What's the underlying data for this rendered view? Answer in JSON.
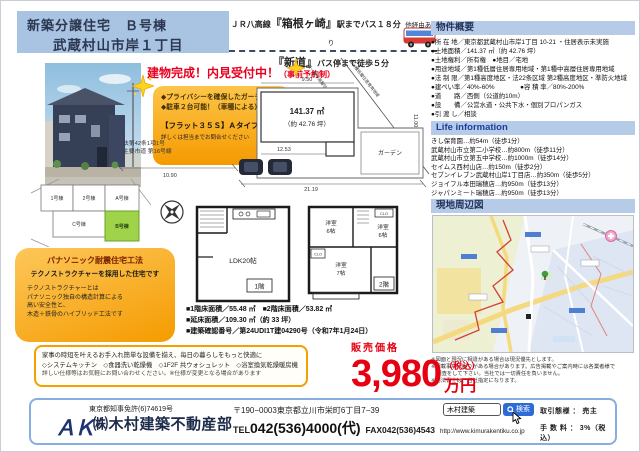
{
  "colors": {
    "accent_blue": "#a9c3e3",
    "bar_blue": "#b5cbe8",
    "price_red": "#e60012",
    "feature_orange": "#f59a00",
    "lot_green": "#9ed34a",
    "navy": "#24335c"
  },
  "header": {
    "line1": "新築分譲住宅　Ｂ号棟",
    "line2": "武蔵村山市岸１丁目"
  },
  "access": {
    "line1_pre": "ＪＲ八高線",
    "station": "『箱根ヶ崎』",
    "line1_post": "駅までバス１８分",
    "line1_note": "他経由あり",
    "stop": "『新道』",
    "line2_post": "バス停まで徒歩５分"
  },
  "completion": {
    "main": "建物完成！内見受付中！",
    "sub": "（事前予約制）"
  },
  "features": {
    "item1": "◆プライバシーを確保したガーデン",
    "item2": "◆駐車２台可能！（車種による）",
    "flat35": "【フラット３５Ｓ】Ａタイプ利用可",
    "note": "詳しくは担当までお問合せください"
  },
  "overview": {
    "title": "物件概要",
    "items": [
      "●所 在 地／東京都武蔵村山市岸1丁目 10-21 ・住居表示未実施",
      "●土地面積／141.37 ㎡（約 42.76 坪）",
      "●土地権利／所有権　●地目／宅地",
      "●用途地域／第1種低層住居専用地域・第1種中高層住居専用地域",
      "●法 制 限／第1種高度地区・法22条区域 第2種高度地区・準防火地域",
      "●建ぺい率／40%-60%　　　　●容 積 率／80%-200%",
      "●道　　路／西側（公道約10m）",
      "●設　　備／公営水道・公共下水・個別プロパンガス",
      "●引 渡 し／相談"
    ]
  },
  "life": {
    "title": "Life information",
    "items": [
      "きし保育園…約54m（徒歩1分）",
      "武蔵村山市立第二小学校…約800m（徒歩11分）",
      "武蔵村山市立第五中学校…約1000m（徒歩14分）",
      "セイムス西村山店…約150m（徒歩2分）",
      "セブンイレブン武蔵村山岸1丁目店…約350m（徒歩5分）",
      "ジョイフル本田瑞穂店…約950m（徒歩13分）",
      "ジャパンミート瑞穂店…約950m（徒歩13分）"
    ]
  },
  "map_section": {
    "title": "現地周辺図"
  },
  "notes": {
    "items": [
      "※図面と現況に相違がある場合は現況優先とします。",
      "※記載事項に誤りがある場合があります。広告掲載やご案内時には各業者様で",
      "　調査をして下さい。当社では一切責任を負いません。",
      "※司法書士は、当社指定になります。"
    ]
  },
  "siteplan": {
    "area_sqm": "141.37 ㎡",
    "area_tsubo": "（約 42.76 坪）",
    "garden": "ガーデン",
    "dim_top": "9.50",
    "dim_right": "11.00",
    "dim_inner": "12.53",
    "dim_bottom": "21.19",
    "dim_road": "10.90",
    "road_law": "法第42条1項1号",
    "road_name": "主要市道 第16号線",
    "zone1": "第一種中高層住居専用地域",
    "zone2": "第一種低層住居専用地域"
  },
  "lotmap": {
    "lot1": "1号棟",
    "lot2": "2号棟",
    "lot3": "A号棟",
    "lot4": "C号棟",
    "lot5": "B号棟"
  },
  "floorplan": {
    "ldk": "LDK20帖",
    "f1": "1階",
    "f2": "2階",
    "room1": "洋室",
    "room1_size": "6帖",
    "room2": "洋室",
    "room2_size": "6帖",
    "room3": "洋室",
    "room3_size": "7帖",
    "clo": "CLO"
  },
  "construction": {
    "title": "パナソニック耐震住宅工法",
    "subtitle": "テクノストラクチャーを採用した住宅です",
    "line1": "テクノストラクチャーとは",
    "line2": "パナソニック独自の構造計算による",
    "line3": "高い安全性と、",
    "line4": "木造＋鉄骨のハイブリッド工法です"
  },
  "equipment": {
    "line1": "家事の時短を叶えるお手入れ簡単な設備を揃え、毎日の暮らしをもっと快適に",
    "line2": "◇システムキッチン　◇食器洗い乾燥機　◇1F2F 共ウォシュレット　◇浴室換気乾燥暖房機",
    "line3": "詳しい仕様等はお気軽にお問い合わせください。※仕様が変更となる場合があります"
  },
  "areas": {
    "line1": "■1階床面積／55.48 ㎡　■2階床面積／53.82 ㎡",
    "line2": "■延床面積／109.30 ㎡（約 33 坪）",
    "line3": "■建築確認番号／第24UDI1T建04290号（令和7年1月24日）"
  },
  "price": {
    "label": "販売価格",
    "value": "3,980",
    "tax": "（税込）",
    "unit": "万円"
  },
  "footer": {
    "license": "東京都知事免許(6)74619号",
    "logo": "ＡＫ",
    "company": "㈱木村建築不動産部",
    "address": "〒190−0003東京都立川市栄町6丁目7−39",
    "tel_label": "TEL",
    "tel": "042(536)4000(代)",
    "fax": "FAX042(536)4543",
    "url": "http://www.kimurakentiku.co.jp",
    "search_value": "木村建築",
    "search_button": "検索",
    "deal": "取引態様 ： 売主",
    "fee": "手 数 料 ： 3%（税込）"
  }
}
